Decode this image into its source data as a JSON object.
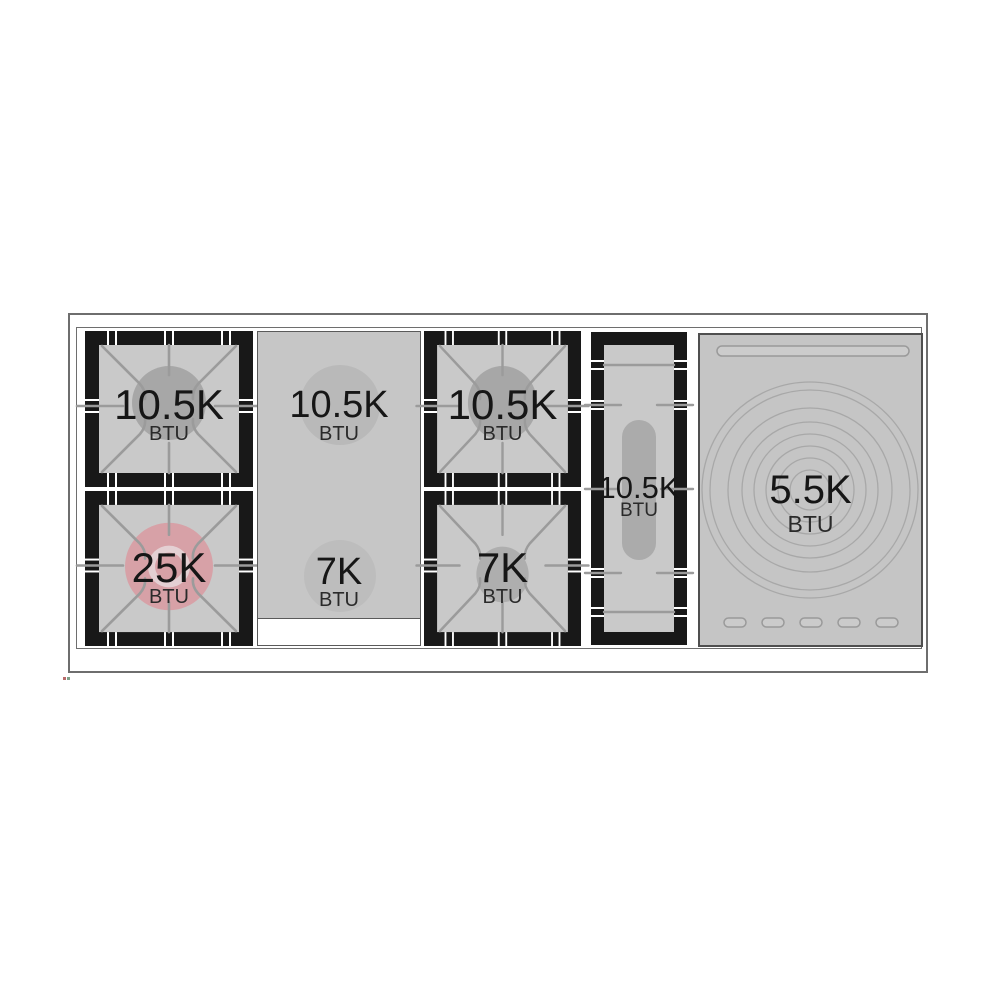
{
  "diagram": {
    "type": "rangetop-burner-layout",
    "burners": [
      {
        "name": "left-rear-gas-burner",
        "value": "10.5K",
        "unit": "BTU"
      },
      {
        "name": "left-front-power-burner",
        "value": "25K",
        "unit": "BTU"
      },
      {
        "name": "center-rear-gas-burner",
        "value": "10.5K",
        "unit": "BTU"
      },
      {
        "name": "center-front-gas-burner",
        "value": "7K",
        "unit": "BTU"
      },
      {
        "name": "right-rear-gas-burner",
        "value": "10.5K",
        "unit": "BTU"
      },
      {
        "name": "right-front-gas-burner",
        "value": "7K",
        "unit": "BTU"
      },
      {
        "name": "griddle-burner",
        "value": "10.5K",
        "unit": "BTU"
      },
      {
        "name": "simmer-plate",
        "value": "5.5K",
        "unit": "BTU"
      }
    ],
    "colors": {
      "panel_gray": "#c6c6c6",
      "grate_frame_black": "#181818",
      "grate_line_gray": "#9b9b9b",
      "burner_circle_gray": "#a7a7a7",
      "power_burner_pink": "#d7a1a7",
      "text_black": "#161616"
    }
  }
}
